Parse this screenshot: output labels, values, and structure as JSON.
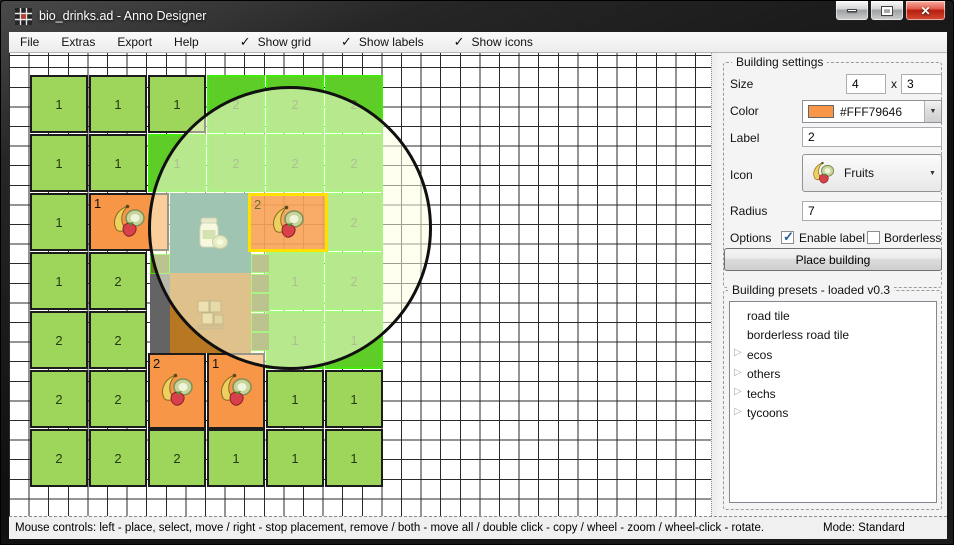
{
  "window": {
    "title": "bio_drinks.ad - Anno Designer"
  },
  "menu": {
    "items": [
      "File",
      "Extras",
      "Export",
      "Help"
    ],
    "toggles": [
      {
        "label": "Show grid",
        "checked": true
      },
      {
        "label": "Show labels",
        "checked": true
      },
      {
        "label": "Show icons",
        "checked": true
      }
    ]
  },
  "settings": {
    "group_title": "Building settings",
    "size_label": "Size",
    "size_width": "4",
    "size_separator": "x",
    "size_height": "3",
    "color_label": "Color",
    "color_value": "#FFF79646",
    "color_swatch": "#F79646",
    "label_label": "Label",
    "label_value": "2",
    "icon_label": "Icon",
    "icon_value": "Fruits",
    "radius_label": "Radius",
    "radius_value": "7",
    "options_label": "Options",
    "enable_label_option": {
      "label": "Enable label",
      "checked": true
    },
    "borderless_option": {
      "label": "Borderless",
      "checked": false
    },
    "place_button": "Place building"
  },
  "presets": {
    "group_title": "Building presets - loaded v0.3",
    "items": [
      {
        "label": "road tile",
        "expandable": false
      },
      {
        "label": "borderless road tile",
        "expandable": false
      },
      {
        "label": "ecos",
        "expandable": true
      },
      {
        "label": "others",
        "expandable": true
      },
      {
        "label": "techs",
        "expandable": true
      },
      {
        "label": "tycoons",
        "expandable": true
      }
    ]
  },
  "status": {
    "mouse_controls": "Mouse controls: left - place, select, move / right - stop placement, remove / both - move all / double click - copy / wheel - zoom / wheel-click - rotate.",
    "mode": "Mode: Standard"
  },
  "canvas": {
    "cell_size": 19.6,
    "grid_color": "#2A2A2A",
    "colors": {
      "green": {
        "fill": "#9ED65B",
        "border": "#1C1C1C",
        "label": "#263A12"
      },
      "highlight": {
        "fill": "#5FCD28",
        "border": "#44E80C",
        "label": "#4E7032"
      },
      "orange": {
        "fill": "#F79646",
        "border": "#1C1C1C",
        "label": "#141414"
      },
      "selected": {
        "fill": "rgba(247,150,70,0.8)",
        "border": "#FFE100",
        "label": "#6E7230"
      },
      "teal": {
        "fill": "#2E7D78"
      },
      "brown": {
        "fill": "#B87722"
      },
      "gray": {
        "fill": "#646464"
      },
      "road": {
        "fill": "#6E7A28",
        "border": "#44E80C"
      }
    },
    "circle": {
      "cx": 281,
      "cy": 175,
      "r": 142
    },
    "buildings": [
      {
        "x": 21,
        "y": 22,
        "w": 58,
        "h": 58,
        "label": "1",
        "type": "green"
      },
      {
        "x": 80,
        "y": 22,
        "w": 58,
        "h": 58,
        "label": "1",
        "type": "green"
      },
      {
        "x": 139,
        "y": 22,
        "w": 58,
        "h": 58,
        "label": "1",
        "type": "green"
      },
      {
        "x": 198,
        "y": 22,
        "w": 58,
        "h": 58,
        "label": "2",
        "type": "highlight"
      },
      {
        "x": 257,
        "y": 22,
        "w": 58,
        "h": 58,
        "label": "2",
        "type": "highlight"
      },
      {
        "x": 316,
        "y": 22,
        "w": 58,
        "h": 58,
        "label": "2",
        "type": "highlight"
      },
      {
        "x": 21,
        "y": 81,
        "w": 58,
        "h": 58,
        "label": "1",
        "type": "green"
      },
      {
        "x": 80,
        "y": 81,
        "w": 58,
        "h": 58,
        "label": "1",
        "type": "green"
      },
      {
        "x": 139,
        "y": 81,
        "w": 58,
        "h": 58,
        "label": "1",
        "type": "highlight"
      },
      {
        "x": 198,
        "y": 81,
        "w": 58,
        "h": 58,
        "label": "2",
        "type": "highlight"
      },
      {
        "x": 257,
        "y": 81,
        "w": 58,
        "h": 58,
        "label": "2",
        "type": "highlight"
      },
      {
        "x": 316,
        "y": 81,
        "w": 58,
        "h": 58,
        "label": "2",
        "type": "highlight"
      },
      {
        "x": 21,
        "y": 140,
        "w": 58,
        "h": 58,
        "label": "1",
        "type": "green"
      },
      {
        "x": 80,
        "y": 140,
        "w": 80,
        "h": 58,
        "label": "1",
        "type": "orange",
        "icon": "fruits"
      },
      {
        "x": 161,
        "y": 140,
        "w": 81,
        "h": 80,
        "label": "",
        "type": "teal",
        "icon": "jar"
      },
      {
        "x": 316,
        "y": 140,
        "w": 58,
        "h": 58,
        "label": "2",
        "type": "highlight"
      },
      {
        "x": 21,
        "y": 199,
        "w": 58,
        "h": 58,
        "label": "1",
        "type": "green"
      },
      {
        "x": 80,
        "y": 199,
        "w": 58,
        "h": 58,
        "label": "2",
        "type": "green"
      },
      {
        "x": 257,
        "y": 199,
        "w": 58,
        "h": 58,
        "label": "1",
        "type": "highlight"
      },
      {
        "x": 316,
        "y": 199,
        "w": 58,
        "h": 58,
        "label": "2",
        "type": "highlight"
      },
      {
        "x": 141,
        "y": 201,
        "w": 20,
        "h": 20,
        "label": "",
        "type": "road"
      },
      {
        "x": 242,
        "y": 201,
        "w": 19,
        "h": 19,
        "label": "",
        "type": "road"
      },
      {
        "x": 161,
        "y": 220,
        "w": 81,
        "h": 80,
        "label": "",
        "type": "brown",
        "icon": "crates"
      },
      {
        "x": 141,
        "y": 221,
        "w": 20,
        "h": 79,
        "label": "",
        "type": "gray"
      },
      {
        "x": 242,
        "y": 221,
        "w": 19,
        "h": 19,
        "label": "",
        "type": "road"
      },
      {
        "x": 242,
        "y": 240,
        "w": 19,
        "h": 19,
        "label": "",
        "type": "road"
      },
      {
        "x": 21,
        "y": 258,
        "w": 58,
        "h": 58,
        "label": "2",
        "type": "green"
      },
      {
        "x": 80,
        "y": 258,
        "w": 58,
        "h": 58,
        "label": "2",
        "type": "green"
      },
      {
        "x": 257,
        "y": 258,
        "w": 58,
        "h": 58,
        "label": "1",
        "type": "highlight"
      },
      {
        "x": 316,
        "y": 258,
        "w": 58,
        "h": 58,
        "label": "1",
        "type": "highlight"
      },
      {
        "x": 242,
        "y": 260,
        "w": 19,
        "h": 19,
        "label": "",
        "type": "road"
      },
      {
        "x": 242,
        "y": 279,
        "w": 19,
        "h": 19,
        "label": "",
        "type": "road"
      },
      {
        "x": 139,
        "y": 300,
        "w": 58,
        "h": 76,
        "label": "2",
        "type": "orange",
        "icon": "fruits"
      },
      {
        "x": 198,
        "y": 300,
        "w": 58,
        "h": 76,
        "label": "1",
        "type": "orange",
        "icon": "fruits"
      },
      {
        "x": 21,
        "y": 317,
        "w": 58,
        "h": 58,
        "label": "2",
        "type": "green"
      },
      {
        "x": 80,
        "y": 317,
        "w": 58,
        "h": 58,
        "label": "2",
        "type": "green"
      },
      {
        "x": 257,
        "y": 317,
        "w": 58,
        "h": 58,
        "label": "1",
        "type": "green"
      },
      {
        "x": 316,
        "y": 317,
        "w": 58,
        "h": 58,
        "label": "1",
        "type": "green"
      },
      {
        "x": 21,
        "y": 376,
        "w": 58,
        "h": 58,
        "label": "2",
        "type": "green"
      },
      {
        "x": 80,
        "y": 376,
        "w": 58,
        "h": 58,
        "label": "2",
        "type": "green"
      },
      {
        "x": 139,
        "y": 376,
        "w": 58,
        "h": 58,
        "label": "2",
        "type": "green"
      },
      {
        "x": 198,
        "y": 376,
        "w": 58,
        "h": 58,
        "label": "1",
        "type": "green"
      },
      {
        "x": 257,
        "y": 376,
        "w": 58,
        "h": 58,
        "label": "1",
        "type": "green"
      },
      {
        "x": 316,
        "y": 376,
        "w": 58,
        "h": 58,
        "label": "1",
        "type": "green"
      },
      {
        "x": 239,
        "y": 140,
        "w": 80,
        "h": 59,
        "label": "2",
        "type": "selected",
        "icon": "fruits"
      }
    ]
  }
}
